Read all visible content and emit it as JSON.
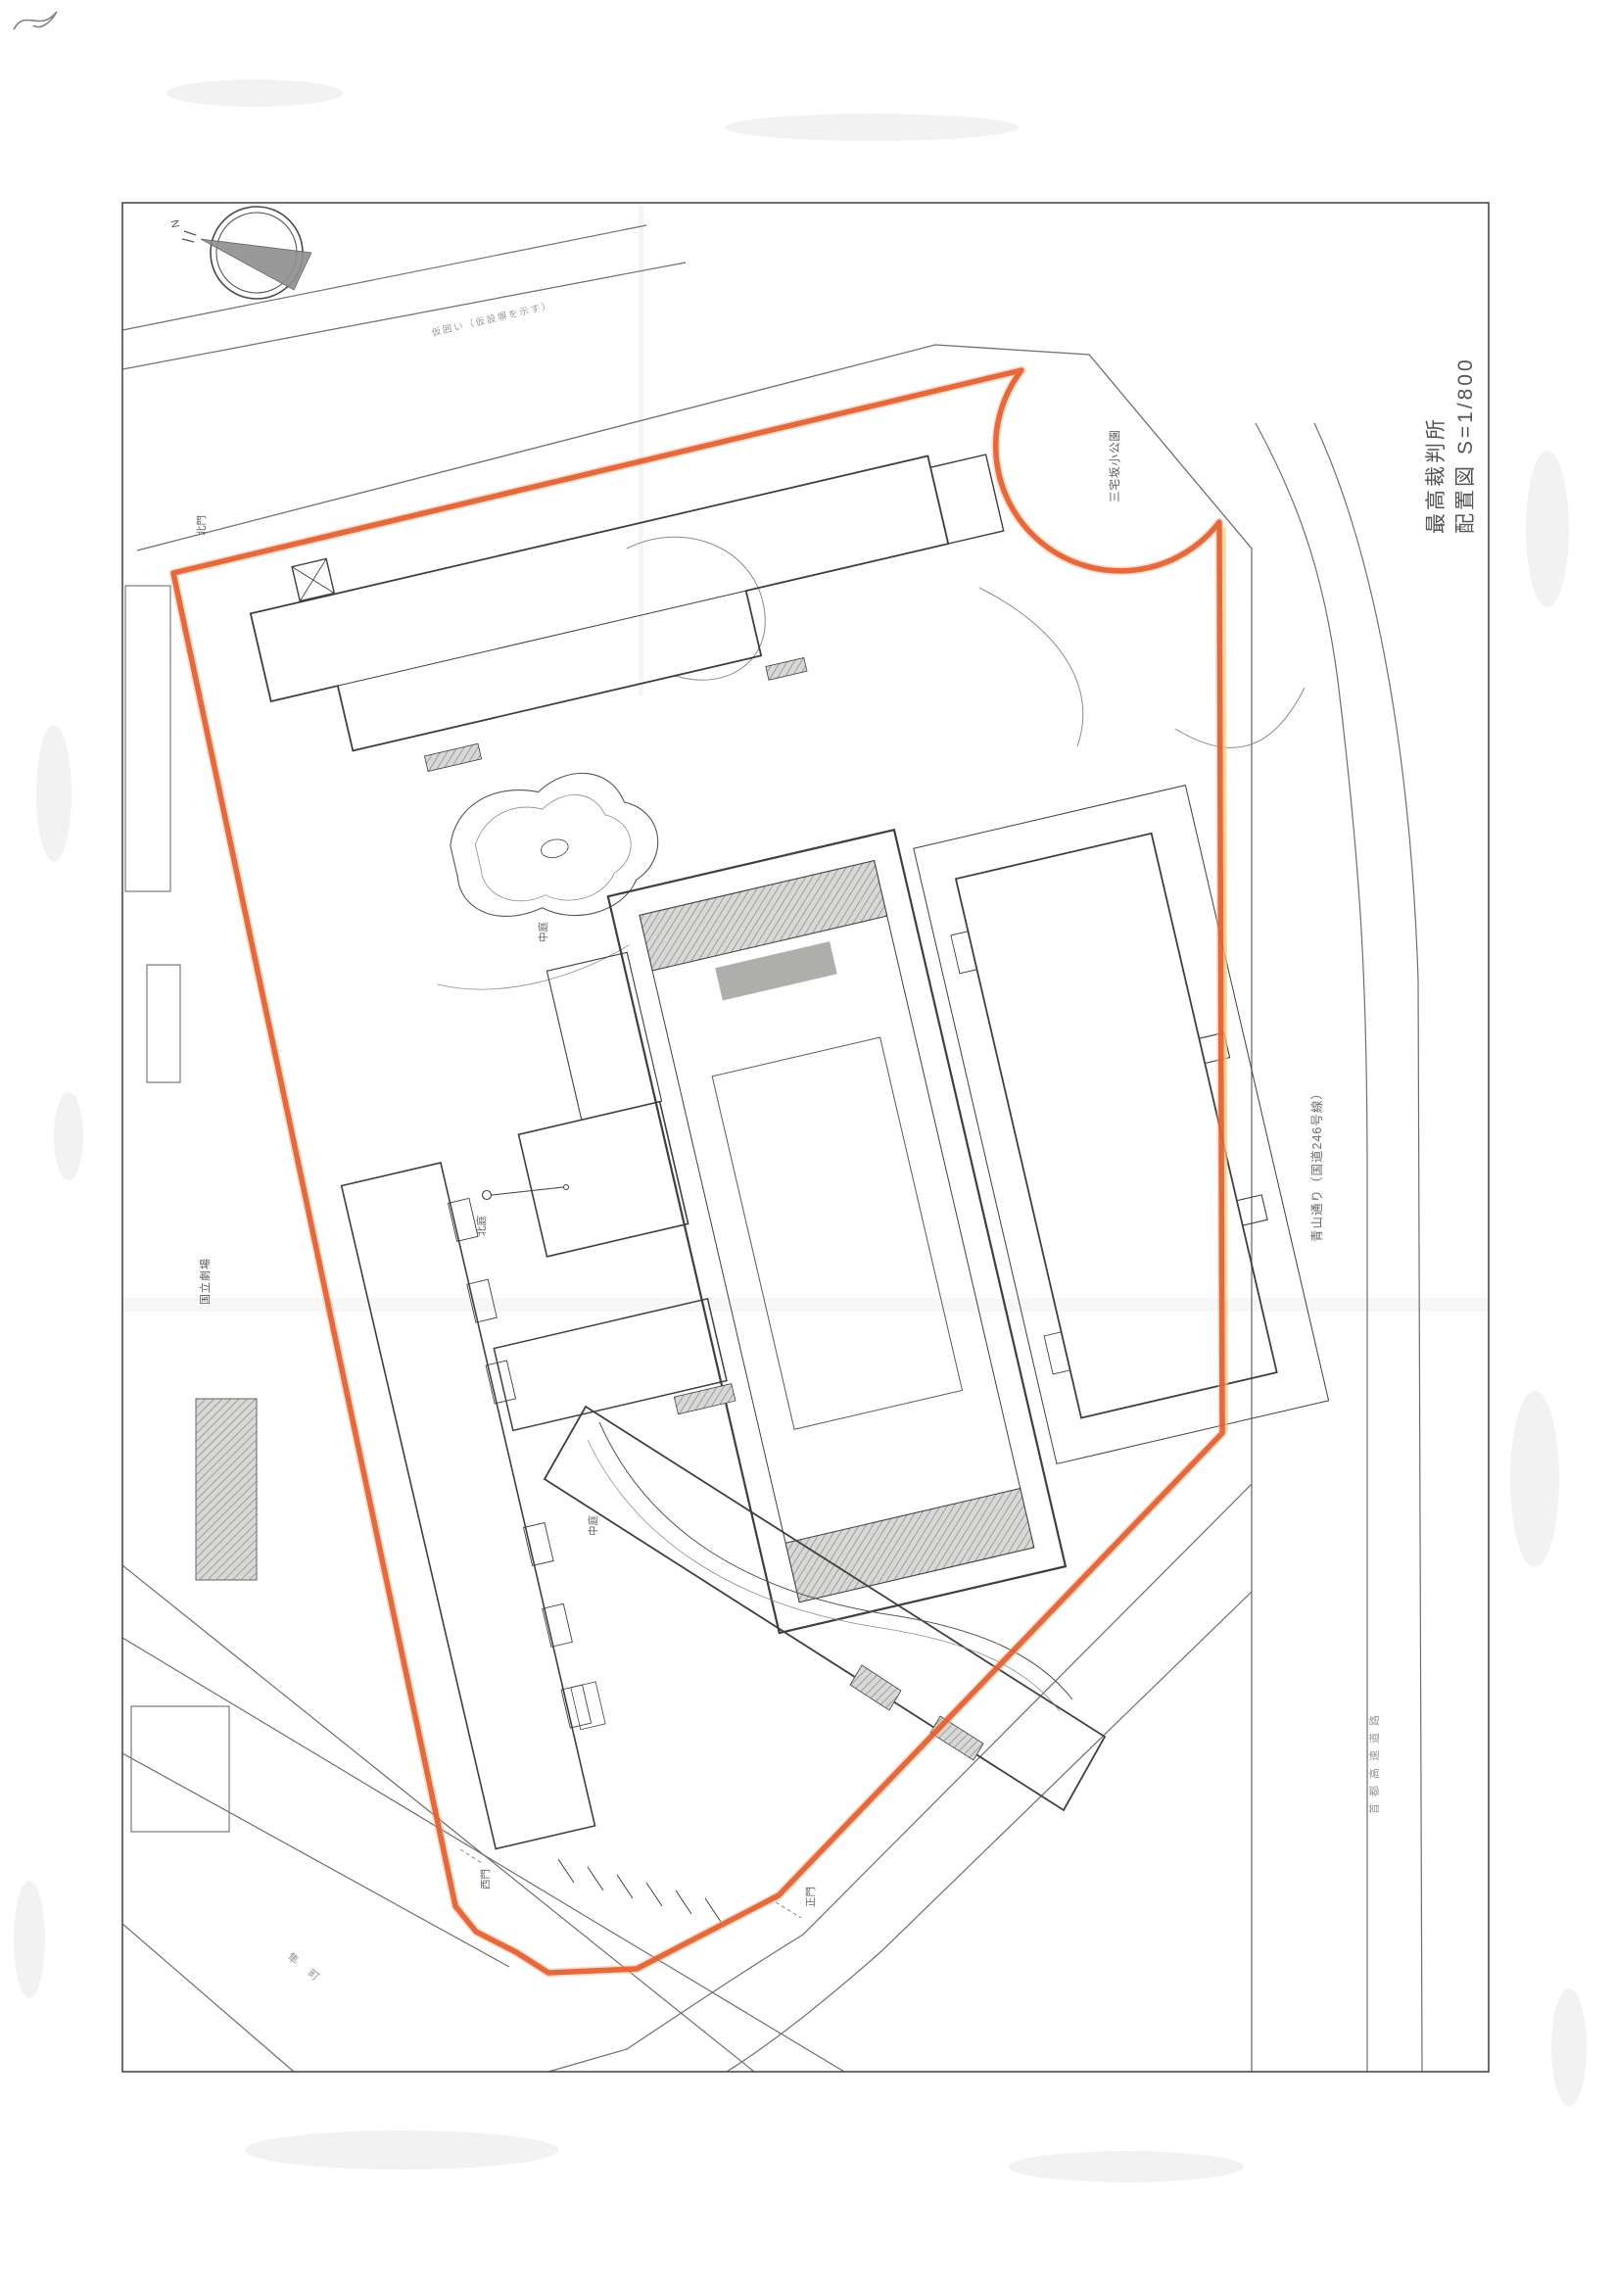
{
  "page": {
    "title_line1": "最高裁判所",
    "title_line2": "配置図  S=1/800",
    "compass_n": "N"
  },
  "roads": {
    "aoyama_dori": "青山通り（国道246号線）",
    "expressway": "首都高速道路",
    "hayabusa_cho": "隼町"
  },
  "surroundings": {
    "miyakezaka_park": "三宅坂小公園",
    "national_theatre": "国立劇場"
  },
  "site": {
    "north_garden": "北庭",
    "pond_court": "中庭",
    "south_court": "中庭",
    "west_gate": "西門",
    "main_gate": "正門",
    "north_gate": "北門",
    "fence_note": "仮囲い（仮設塀を示す）"
  },
  "colors": {
    "boundary": "#e15c2c",
    "line": "#3f3f3f",
    "paper": "#ffffff"
  }
}
